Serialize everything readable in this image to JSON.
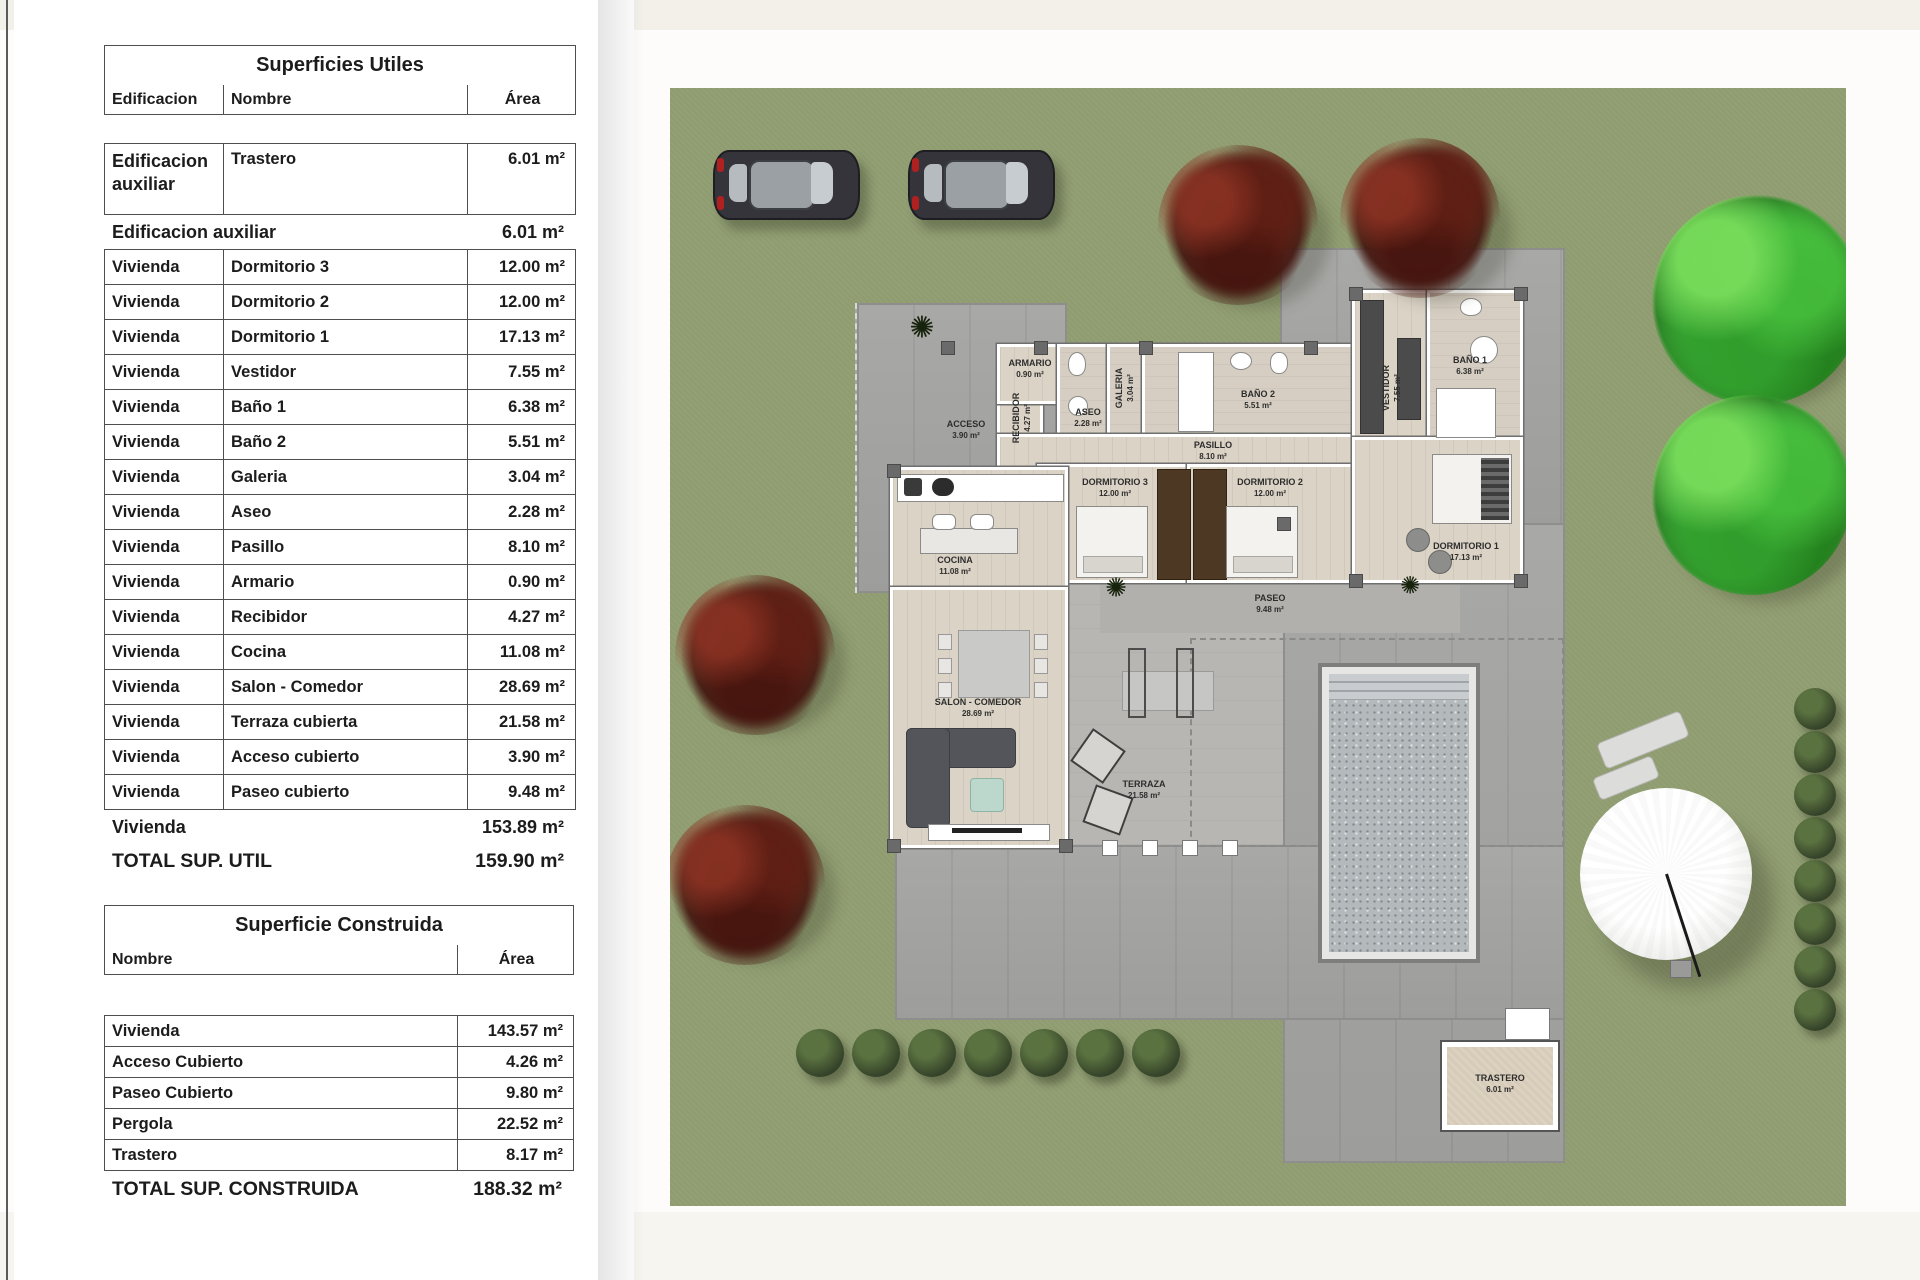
{
  "tables": {
    "utiles": {
      "title": "Superficies Utiles",
      "columns": [
        "Edificacion",
        "Nombre",
        "Área"
      ],
      "aux_row": {
        "edificacion": "Edificacion auxiliar",
        "nombre": "Trastero",
        "area": "6.01 m²"
      },
      "aux_subtotal": {
        "label": "Edificacion auxiliar",
        "area": "6.01 m²"
      },
      "rows": [
        {
          "edificacion": "Vivienda",
          "nombre": "Dormitorio 3",
          "area": "12.00 m²"
        },
        {
          "edificacion": "Vivienda",
          "nombre": "Dormitorio 2",
          "area": "12.00 m²"
        },
        {
          "edificacion": "Vivienda",
          "nombre": "Dormitorio 1",
          "area": "17.13 m²"
        },
        {
          "edificacion": "Vivienda",
          "nombre": "Vestidor",
          "area": "7.55 m²"
        },
        {
          "edificacion": "Vivienda",
          "nombre": "Baño 1",
          "area": "6.38 m²"
        },
        {
          "edificacion": "Vivienda",
          "nombre": "Baño 2",
          "area": "5.51 m²"
        },
        {
          "edificacion": "Vivienda",
          "nombre": "Galeria",
          "area": "3.04 m²"
        },
        {
          "edificacion": "Vivienda",
          "nombre": "Aseo",
          "area": "2.28 m²"
        },
        {
          "edificacion": "Vivienda",
          "nombre": "Pasillo",
          "area": "8.10 m²"
        },
        {
          "edificacion": "Vivienda",
          "nombre": "Armario",
          "area": "0.90 m²"
        },
        {
          "edificacion": "Vivienda",
          "nombre": "Recibidor",
          "area": "4.27 m²"
        },
        {
          "edificacion": "Vivienda",
          "nombre": "Cocina",
          "area": "11.08 m²"
        },
        {
          "edificacion": "Vivienda",
          "nombre": "Salon - Comedor",
          "area": "28.69 m²"
        },
        {
          "edificacion": "Vivienda",
          "nombre": "Terraza cubierta",
          "area": "21.58 m²"
        },
        {
          "edificacion": "Vivienda",
          "nombre": "Acceso cubierto",
          "area": "3.90 m²"
        },
        {
          "edificacion": "Vivienda",
          "nombre": "Paseo cubierto",
          "area": "9.48 m²"
        }
      ],
      "vivienda_subtotal": {
        "label": "Vivienda",
        "area": "153.89 m²"
      },
      "total": {
        "label": "TOTAL SUP. UTIL",
        "area": "159.90 m²"
      }
    },
    "construida": {
      "title": "Superficie Construida",
      "columns": [
        "Nombre",
        "Área"
      ],
      "rows": [
        {
          "nombre": "Vivienda",
          "area": "143.57 m²"
        },
        {
          "nombre": "Acceso Cubierto",
          "area": "4.26 m²"
        },
        {
          "nombre": "Paseo Cubierto",
          "area": "9.80 m²"
        },
        {
          "nombre": "Pergola",
          "area": "22.52 m²"
        },
        {
          "nombre": "Trastero",
          "area": "8.17 m²"
        }
      ],
      "total": {
        "label": "TOTAL SUP. CONSTRUIDA",
        "area": "188.32 m²"
      }
    }
  },
  "plan": {
    "rooms": [
      {
        "name": "ACCESO",
        "area": "3.90 m²"
      },
      {
        "name": "RECIBIDOR",
        "area": "4.27 m²"
      },
      {
        "name": "ARMARIO",
        "area": "0.90 m²"
      },
      {
        "name": "ASEO",
        "area": "2.28 m²"
      },
      {
        "name": "GALERIA",
        "area": "3.04 m²"
      },
      {
        "name": "BAÑO 2",
        "area": "5.51 m²"
      },
      {
        "name": "PASILLO",
        "area": "8.10 m²"
      },
      {
        "name": "DORMITORIO 3",
        "area": "12.00 m²"
      },
      {
        "name": "DORMITORIO 2",
        "area": "12.00 m²"
      },
      {
        "name": "COCINA",
        "area": "11.08 m²"
      },
      {
        "name": "SALON - COMEDOR",
        "area": "28.69 m²"
      },
      {
        "name": "TERRAZA",
        "area": "21.58 m²"
      },
      {
        "name": "PASEO",
        "area": "9.48 m²"
      },
      {
        "name": "VESTIDOR",
        "area": "7.55 m²"
      },
      {
        "name": "BAÑO 1",
        "area": "6.38 m²"
      },
      {
        "name": "DORMITORIO 1",
        "area": "17.13 m²"
      },
      {
        "name": "TRASTERO",
        "area": "6.01 m²"
      }
    ]
  },
  "colors": {
    "grass": "#8f9c70",
    "patio": "#a2a2a0",
    "terrace": "#b8b6b2",
    "wood_floor": "#dbd3c6",
    "tree_green": "#3fa93c",
    "tree_red": "#5e1f16",
    "bush_green": "#36452a",
    "pool_water": "#b4b9bb",
    "table_border": "#4e4e4e"
  }
}
